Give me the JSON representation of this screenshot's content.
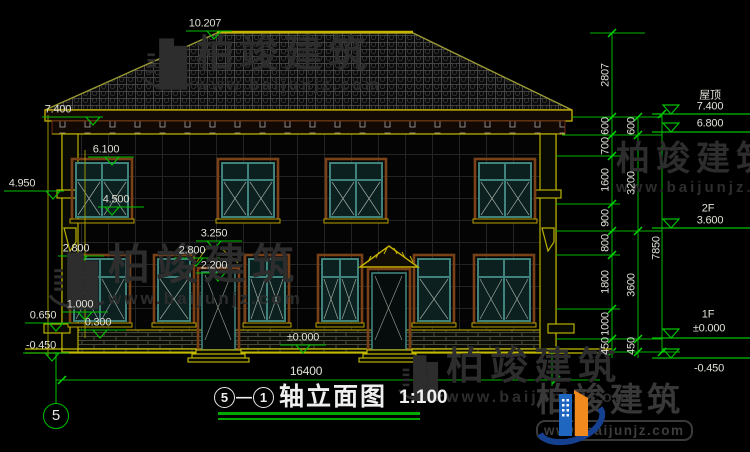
{
  "drawing": {
    "title": {
      "axis_start": "5",
      "axis_end": "1",
      "name": "轴立面图",
      "scale": "1:100"
    },
    "axis_bubble": "5"
  },
  "watermark": {
    "brand": "柏竣建筑",
    "url": "www.baijunjz.com"
  },
  "labels": [
    {
      "n": "level-ridge",
      "t": "10.207",
      "x": 205,
      "y": 24
    },
    {
      "n": "level-left",
      "t": "7.400",
      "x": 58,
      "y": 110
    },
    {
      "n": "level-left",
      "t": "6.100",
      "x": 106,
      "y": 150
    },
    {
      "n": "level-left",
      "t": "4.950",
      "x": 22,
      "y": 184
    },
    {
      "n": "level-left",
      "t": "4.500",
      "x": 116,
      "y": 200
    },
    {
      "n": "level-left",
      "t": "2.800",
      "x": 76,
      "y": 249
    },
    {
      "n": "level-left",
      "t": "3.250",
      "x": 214,
      "y": 234
    },
    {
      "n": "level-left",
      "t": "2.800",
      "x": 192,
      "y": 251
    },
    {
      "n": "level-left",
      "t": "2.200",
      "x": 214,
      "y": 266
    },
    {
      "n": "level-left",
      "t": "1.000",
      "x": 80,
      "y": 305
    },
    {
      "n": "level-left",
      "t": "0.650",
      "x": 43,
      "y": 316
    },
    {
      "n": "level-left",
      "t": "0.300",
      "x": 98,
      "y": 323
    },
    {
      "n": "level-left",
      "t": "-0.450",
      "x": 41,
      "y": 346
    },
    {
      "n": "level-floor",
      "t": "±0.000",
      "x": 303,
      "y": 338
    },
    {
      "n": "dim-width-total",
      "t": "16400",
      "x": 306,
      "y": 371,
      "s": 12
    },
    {
      "n": "dim-chain",
      "t": "2807",
      "x": 606,
      "y": 75,
      "r": 1
    },
    {
      "n": "dim-chain",
      "t": "600",
      "x": 606,
      "y": 126,
      "r": 1
    },
    {
      "n": "dim-chain",
      "t": "700",
      "x": 606,
      "y": 146,
      "r": 1
    },
    {
      "n": "dim-chain",
      "t": "1600",
      "x": 606,
      "y": 180,
      "r": 1
    },
    {
      "n": "dim-chain",
      "t": "900",
      "x": 606,
      "y": 218,
      "r": 1
    },
    {
      "n": "dim-chain",
      "t": "800",
      "x": 606,
      "y": 243,
      "r": 1
    },
    {
      "n": "dim-chain",
      "t": "1800",
      "x": 606,
      "y": 282,
      "r": 1
    },
    {
      "n": "dim-chain",
      "t": "1000",
      "x": 606,
      "y": 324,
      "r": 1
    },
    {
      "n": "dim-chain",
      "t": "450",
      "x": 606,
      "y": 346,
      "r": 1
    },
    {
      "n": "dim-chain",
      "t": "600",
      "x": 632,
      "y": 126,
      "r": 1
    },
    {
      "n": "dim-chain",
      "t": "3200",
      "x": 632,
      "y": 183,
      "r": 1
    },
    {
      "n": "dim-chain",
      "t": "3600",
      "x": 632,
      "y": 285,
      "r": 1
    },
    {
      "n": "dim-chain",
      "t": "450",
      "x": 632,
      "y": 346,
      "r": 1
    },
    {
      "n": "dim-height-total",
      "t": "7850",
      "x": 657,
      "y": 248,
      "r": 1
    },
    {
      "n": "level-right",
      "t": "屋顶",
      "x": 710,
      "y": 96
    },
    {
      "n": "level-right",
      "t": "7.400",
      "x": 710,
      "y": 107
    },
    {
      "n": "level-right",
      "t": "6.800",
      "x": 710,
      "y": 124
    },
    {
      "n": "level-right",
      "t": "2F",
      "x": 708,
      "y": 209
    },
    {
      "n": "level-right",
      "t": "3.600",
      "x": 710,
      "y": 221
    },
    {
      "n": "level-right",
      "t": "1F",
      "x": 708,
      "y": 315
    },
    {
      "n": "level-right",
      "t": "±0.000",
      "x": 709,
      "y": 329
    },
    {
      "n": "level-right",
      "t": "-0.450",
      "x": 709,
      "y": 369
    }
  ]
}
